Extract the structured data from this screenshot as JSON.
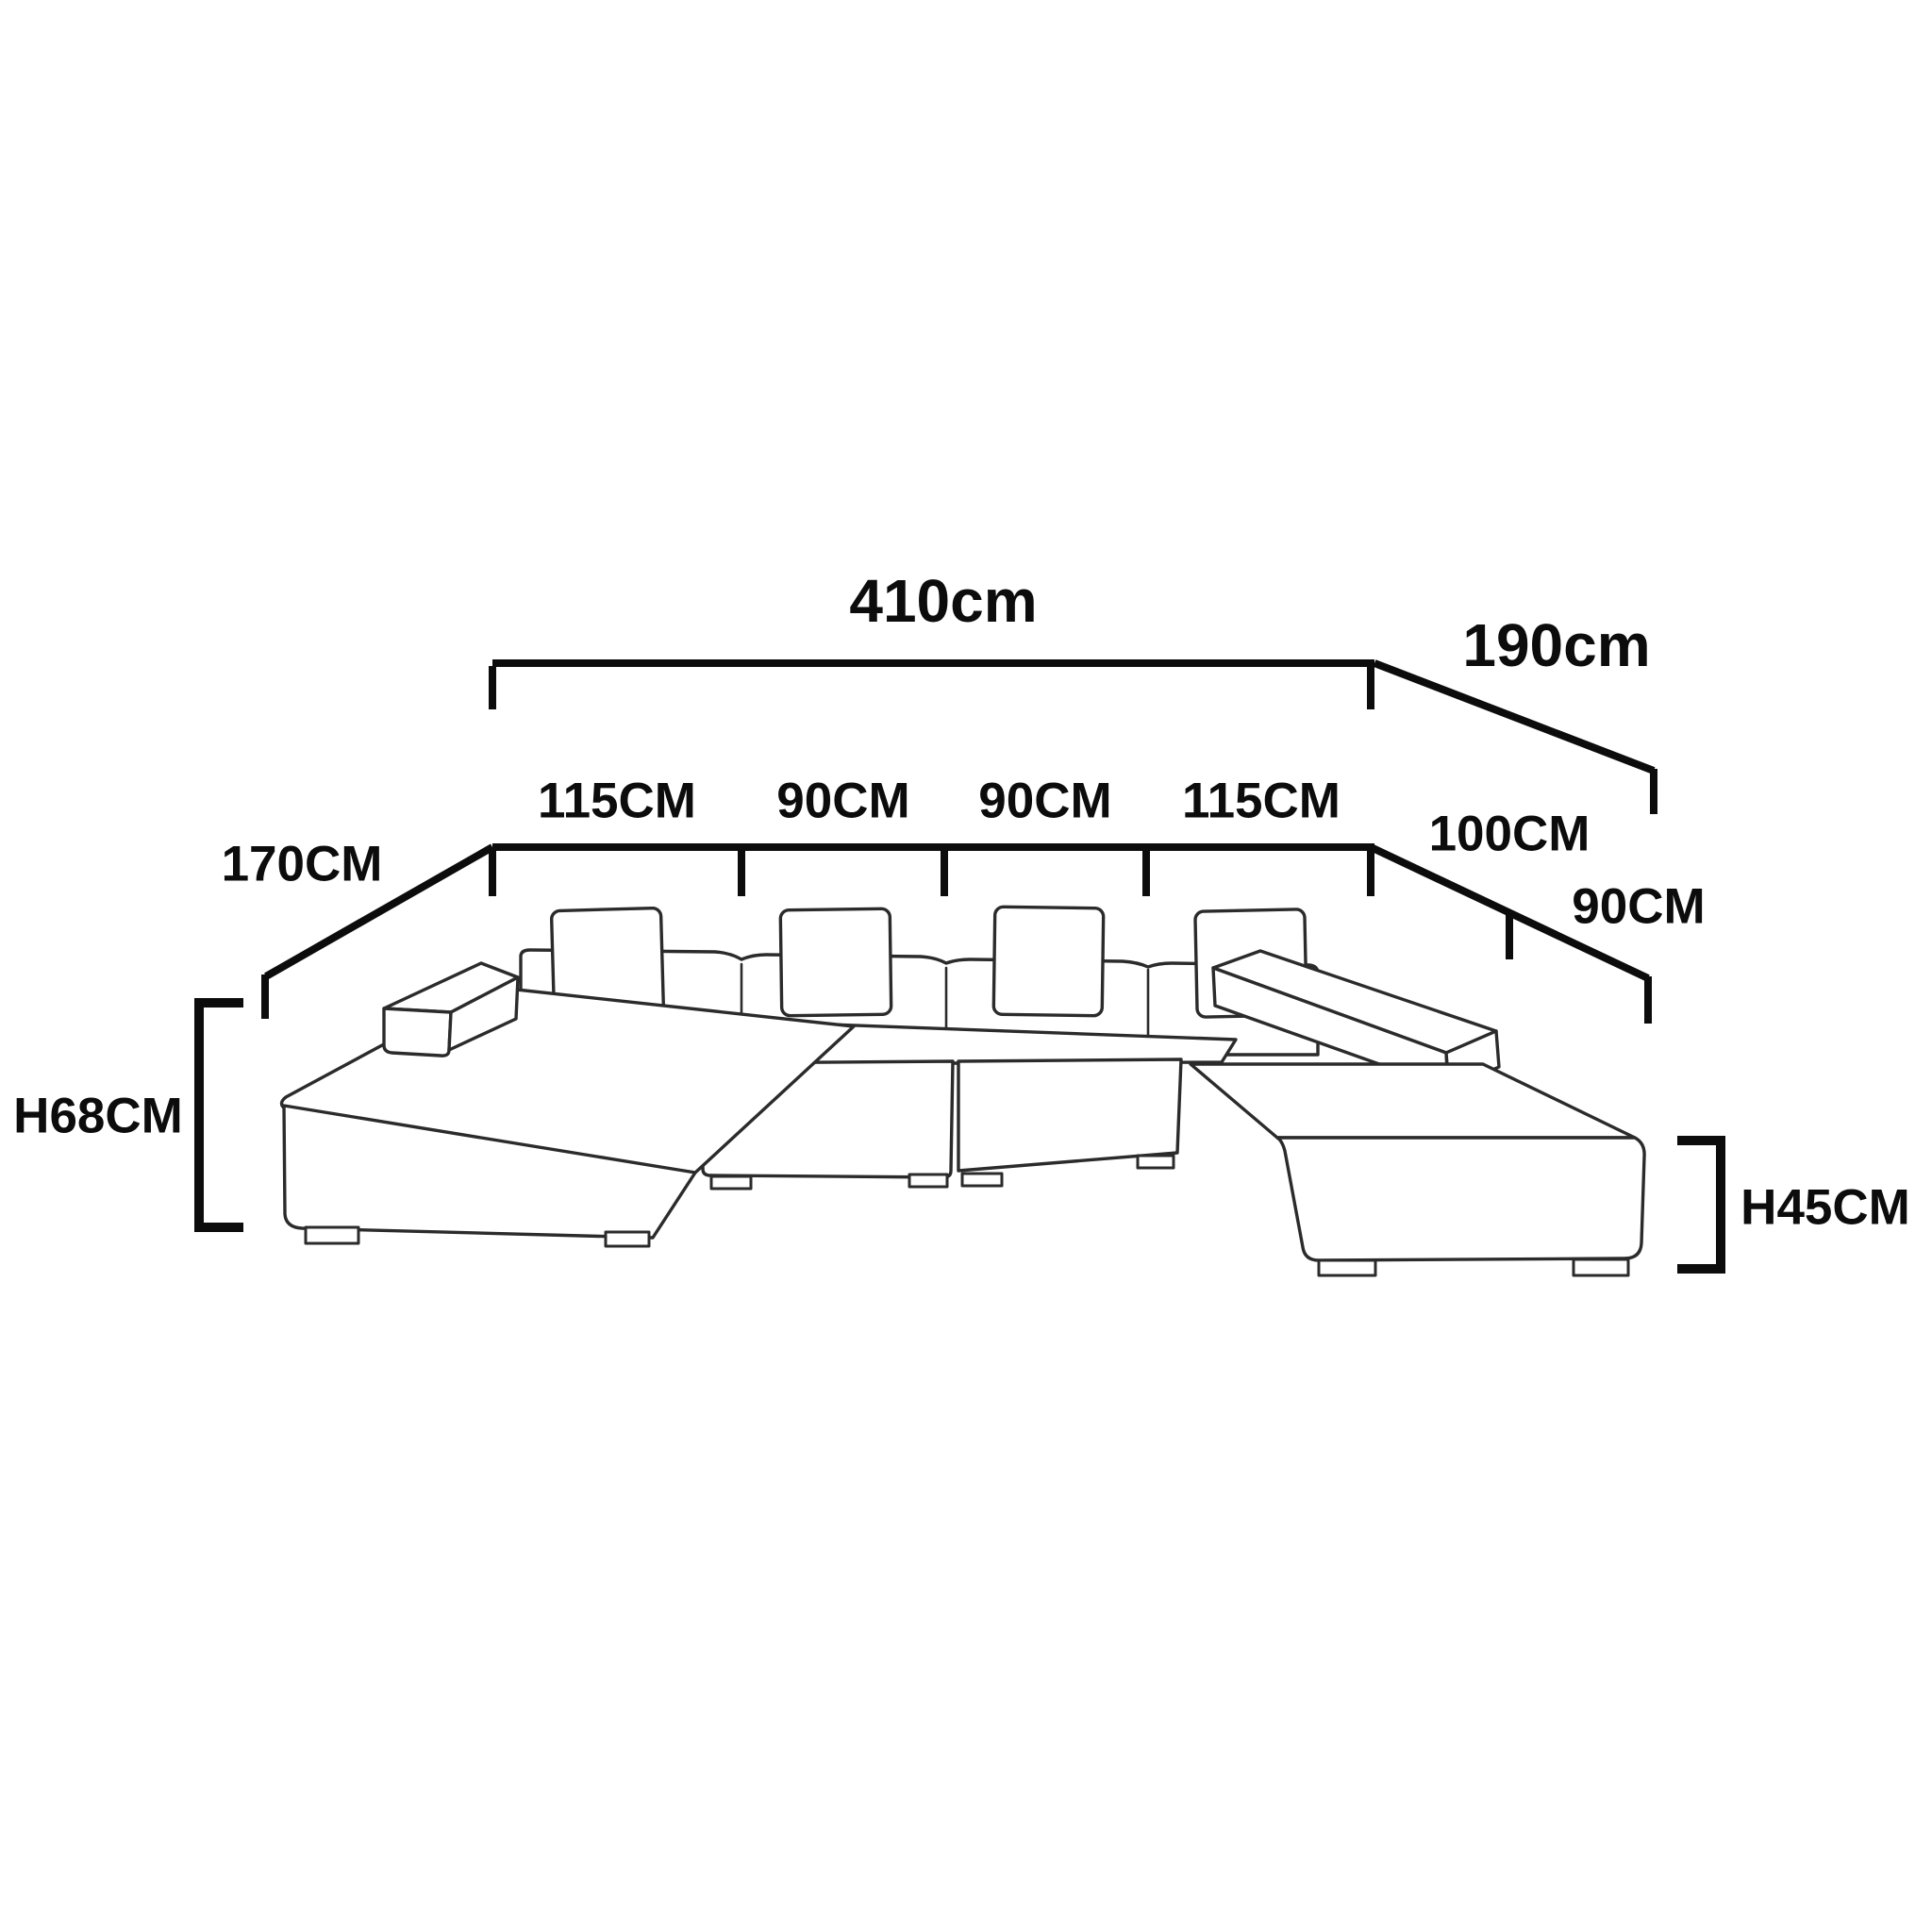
{
  "diagram": {
    "type": "furniture-dimension-diagram",
    "subject": "u-shaped sectional sofa with chaise and ottoman",
    "labels": {
      "overall_width": "410cm",
      "right_outer_depth": "190cm",
      "seat_segments": [
        "115CM",
        "90CM",
        "90CM",
        "115CM"
      ],
      "left_chaise_depth": "170CM",
      "right_inner_depth_front": "100CM",
      "right_inner_depth_back": "90CM",
      "back_height": "H68CM",
      "ottoman_height": "H45CM"
    },
    "colors": {
      "dimension_lines": "#0c0c0c",
      "sofa_outline": "#2b2b2b",
      "background": "#ffffff"
    }
  }
}
